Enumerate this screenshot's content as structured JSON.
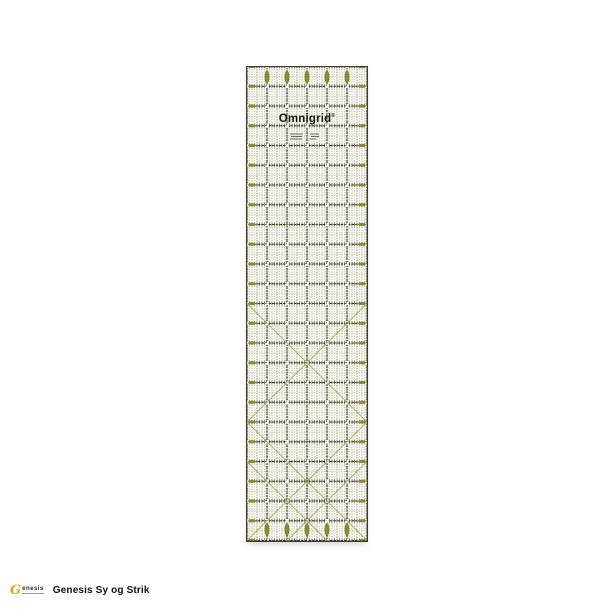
{
  "photo": {
    "ruler_brand": "Omnigrid",
    "ruler_trademark": "®",
    "colors": {
      "background": "#ffffff",
      "ruler_surface": "#fbfaf1",
      "grid_line": "#35352b",
      "accent_olive": "#8f8f28",
      "logo_yellow": "#dfa616"
    }
  },
  "footer": {
    "logo_initial": "G",
    "logo_text_small": "enesis",
    "brand_text": "Genesis Sy og Strik"
  }
}
